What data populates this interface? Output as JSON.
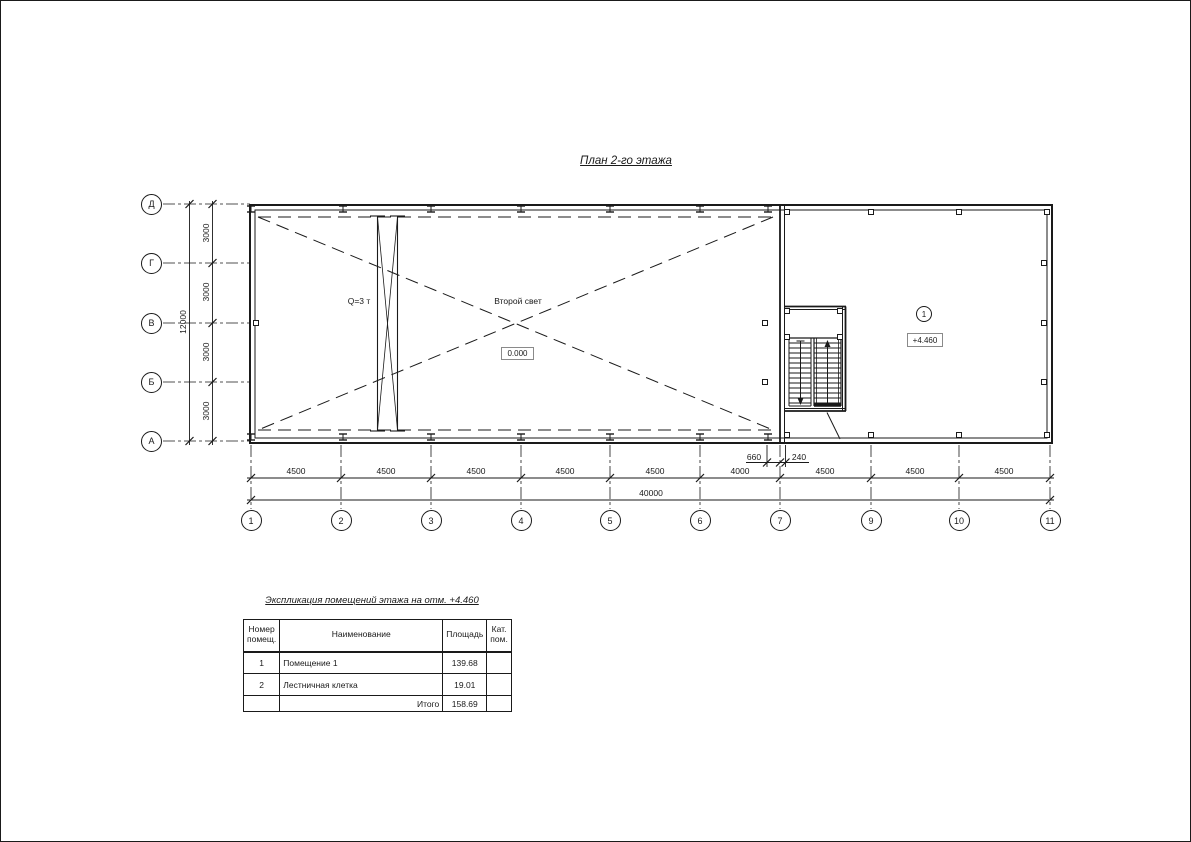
{
  "title": "План 2-го этажа",
  "colors": {
    "line": "#1a1a1a",
    "background": "#ffffff"
  },
  "plan": {
    "crane_label": "Q=3 т",
    "second_light_label": "Второй свет",
    "elevation_zero": "0.000",
    "room_number": "1",
    "room_elevation": "+4.460"
  },
  "axes": {
    "left": [
      "Д",
      "Г",
      "В",
      "Б",
      "А"
    ],
    "bottom": [
      "1",
      "2",
      "3",
      "4",
      "5",
      "6",
      "7",
      "9",
      "10",
      "11"
    ]
  },
  "dimensions": {
    "left_segments": [
      "3000",
      "3000",
      "3000",
      "3000"
    ],
    "left_total": "12000",
    "bottom_segments": [
      "4500",
      "4500",
      "4500",
      "4500",
      "4500",
      "4000",
      "4500",
      "4500",
      "4500"
    ],
    "bottom_total": "40000",
    "stair_offsets": [
      "660",
      "240"
    ]
  },
  "explication": {
    "title": "Экспликация помещений этажа на отм. +4.460",
    "columns": {
      "num": [
        "Номер",
        "помещ."
      ],
      "name": "Наименование",
      "area": "Площадь",
      "cat": [
        "Кат.",
        "пом."
      ]
    },
    "rows": [
      {
        "num": "1",
        "name": "Помещение 1",
        "area": "139.68",
        "cat": ""
      },
      {
        "num": "2",
        "name": "Лестничная клетка",
        "area": "19.01",
        "cat": ""
      },
      {
        "num": "",
        "name": "Итого",
        "area": "158.69",
        "cat": ""
      }
    ]
  }
}
